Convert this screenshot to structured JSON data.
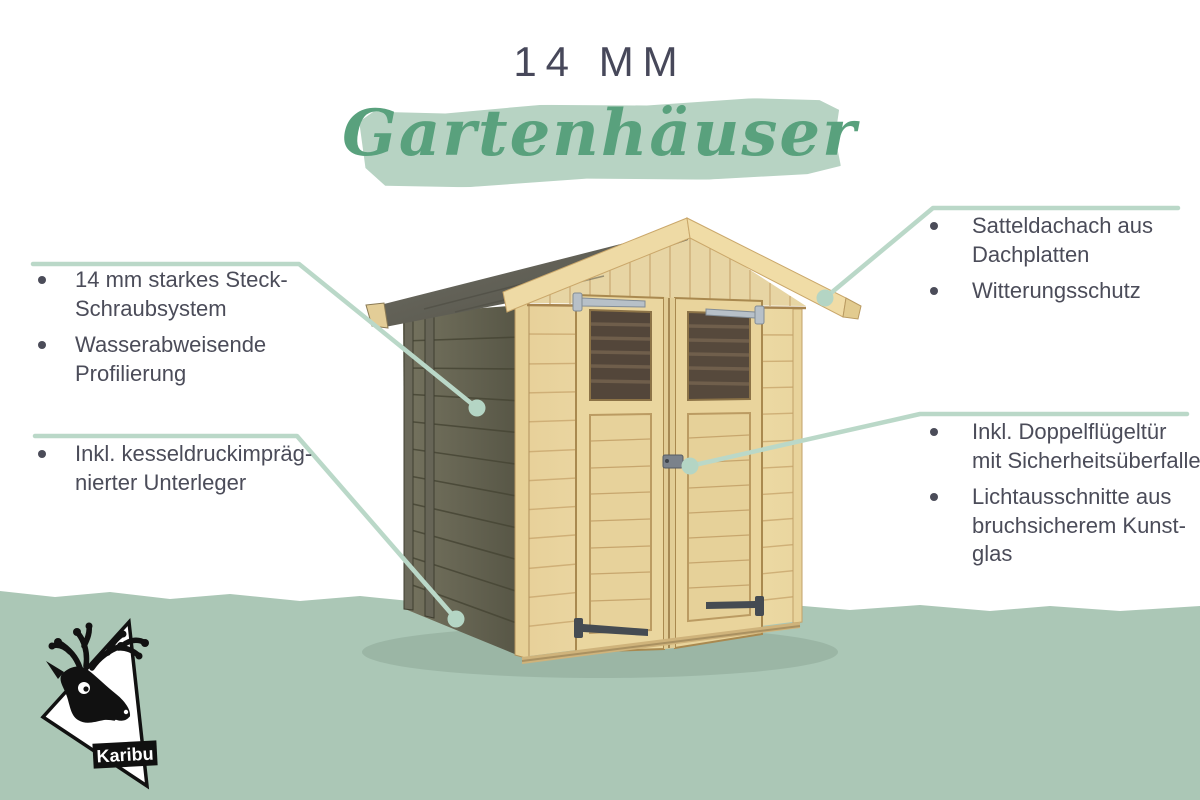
{
  "header": {
    "size_label": "14 MM",
    "category_label": "Gartenhäuser"
  },
  "callouts": {
    "left_top": {
      "items": [
        {
          "lines": [
            "14 mm starkes Steck-",
            "Schraubsystem"
          ]
        },
        {
          "lines": [
            "Wasserabweisende",
            "Profilierung"
          ]
        }
      ]
    },
    "left_bottom": {
      "items": [
        {
          "lines": [
            "Inkl. kesseldruckimpräg-",
            "nierter Unterleger"
          ]
        }
      ]
    },
    "right_top": {
      "items": [
        {
          "lines": [
            "Satteldachach aus",
            "Dachplatten"
          ]
        },
        {
          "lines": [
            "Witterungsschutz"
          ]
        }
      ]
    },
    "right_bottom": {
      "items": [
        {
          "lines": [
            "Inkl. Doppelflügeltür",
            "mit Sicherheitsüberfalle"
          ]
        },
        {
          "lines": [
            "Lichtausschnitte aus",
            "bruchsicherem Kunst-",
            "glas"
          ]
        }
      ]
    }
  },
  "logo": {
    "brand": "Karibu"
  },
  "illustration": {
    "subject": "wooden garden shed with gable roof, dark stained side wall and pine double doors"
  },
  "colors": {
    "accent_green": "#59a17d",
    "soft_green_brush": "#b7d3c3",
    "ground_green": "#abc7b6",
    "callout_line_green": "#bad8c8",
    "text_dark": "#4b4c59",
    "pine_light": "#ecd8a2",
    "wall_dark": "#656350",
    "roof_dark": "#5e5d53"
  }
}
